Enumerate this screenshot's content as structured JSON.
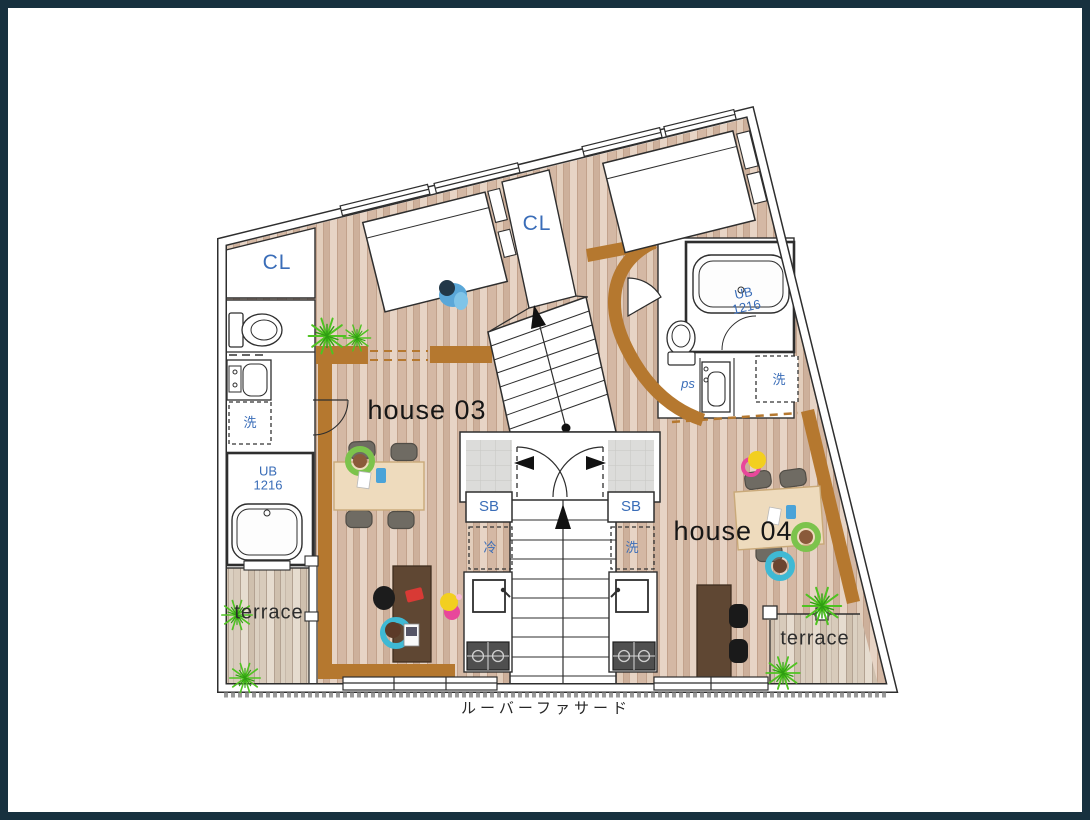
{
  "floor_plan": {
    "units": {
      "house03": {
        "name": "house 03",
        "closet_label": "CL",
        "terrace_label": "terrace",
        "unit_bath_type": "UB",
        "unit_bath_size": "1216",
        "shoe_box_label": "SB",
        "fridge_label": "冷",
        "washer_label": "洗"
      },
      "house04": {
        "name": "house 04",
        "closet_label": "CL",
        "terrace_label": "terrace",
        "unit_bath_type": "UB",
        "unit_bath_size": "1216",
        "shoe_box_label": "SB",
        "fridge_label": "洗",
        "washer_label": "洗",
        "pipe_space_label": "ps"
      }
    },
    "facade_label": "ルーバーファサード"
  },
  "colors": {
    "frame": "#17313f",
    "wall_line": "#2e2e2e",
    "accent_band": "#b5782f",
    "label_blue": "#3a6db8",
    "label_dark": "#1d1d1d",
    "plant_green": "#4fc321",
    "tile_gray": "#dcdcda"
  }
}
